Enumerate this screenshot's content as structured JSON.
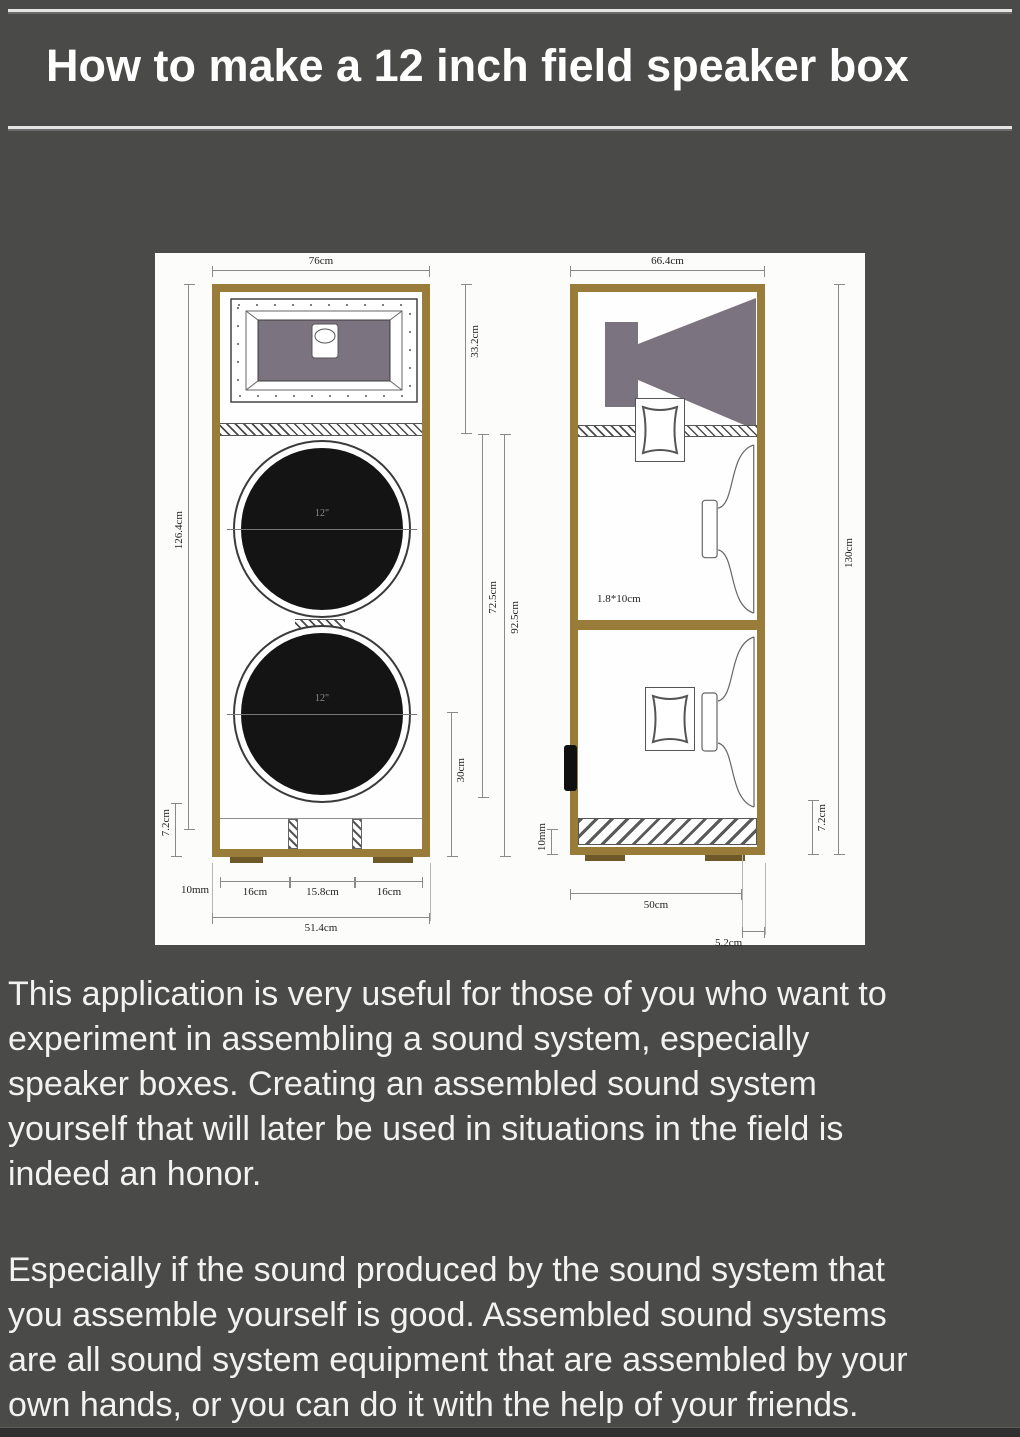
{
  "title": "How to make a 12 inch field speaker box",
  "colors": {
    "background": "#4a4a48",
    "wood_frame": "#9a7c3a",
    "horn_gray": "#7c7380",
    "speaker_cone": "#141414",
    "diagram_paper": "#fcfcfa",
    "body_text": "#f2f2f2"
  },
  "diagram": {
    "front_view": {
      "width_top": "76cm",
      "horn_section_height": "33.2cm",
      "total_inner_height": "126.4cm",
      "base_height": "7.2cm",
      "speaker_section_height": "92.5cm",
      "speaker_section_inner_height": "72.5cm",
      "port_section_height": "30cm",
      "wall_thickness": "10mm",
      "port_span_left": "16cm",
      "port_span_center": "15.8cm",
      "port_span_right": "16cm",
      "width_bottom": "51.4cm",
      "upper_speaker_label": "12\"",
      "lower_speaker_label": "12\""
    },
    "side_view": {
      "width_top": "66.4cm",
      "total_height": "130cm",
      "brace_size": "1.8*10cm",
      "width_bottom": "50cm",
      "back_offset": "5.2cm",
      "base_height": "7.2cm",
      "wall_thickness": "10mm"
    }
  },
  "paragraphs": [
    {
      "lines": [
        "This application is very useful for those of you who want to",
        "experiment in assembling a sound system, especially",
        "speaker boxes. Creating an assembled sound system",
        "yourself that will later be used in situations in the field is",
        "indeed an honor."
      ]
    },
    {
      "lines": [
        "Especially if the sound produced by the sound system that",
        "you assemble yourself is good. Assembled sound systems",
        "are all sound system equipment that are assembled by your",
        "own hands, or you can do it with the help of your friends."
      ]
    }
  ]
}
